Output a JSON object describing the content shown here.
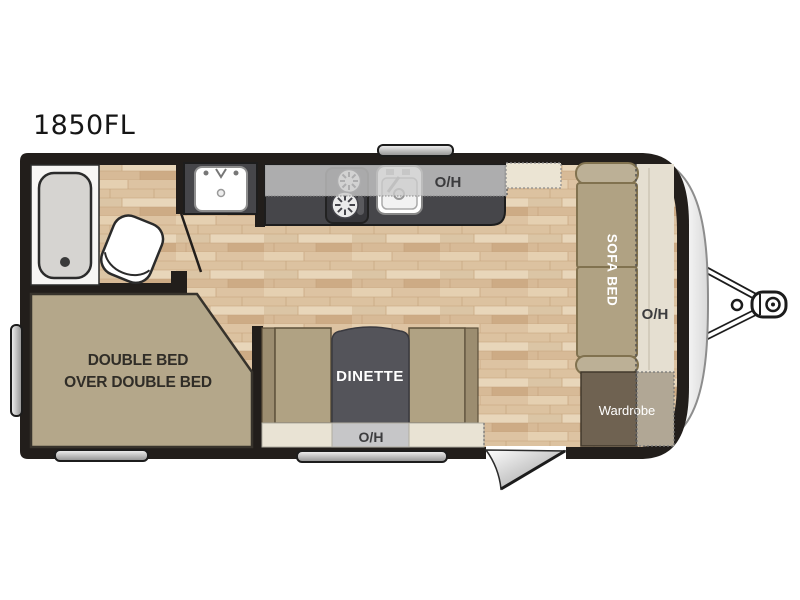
{
  "page": {
    "title_label": "1850FL"
  },
  "floorplan": {
    "model": "1850FL",
    "bed": {
      "line1": "DOUBLE BED",
      "line2": "OVER DOUBLE BED"
    },
    "dinette": {
      "label": "DINETTE",
      "overhead_label": "O/H"
    },
    "kitchen": {
      "overhead_label": "O/H"
    },
    "sofa": {
      "label": "SOFA BED"
    },
    "front": {
      "overhead_label": "O/H"
    },
    "wardrobe": {
      "label": "Wardrobe"
    },
    "colors": {
      "wall": "#221e1b",
      "floor_base": "#e5d0b1",
      "furniture_tan": "#b0a283",
      "armrest_tan": "#bcb096",
      "counter_dark": "#46464a",
      "table_grey": "#54545a",
      "overhead_grey": "#c9c9cb",
      "overhead_cream": "#e9e3d4",
      "wardrobe_brown": "#6f6251",
      "wardrobe_ext": "#b1a795",
      "tub_grey": "#d6d4d1",
      "label_dark": "#302d27",
      "label_light": "#ffffff"
    }
  }
}
